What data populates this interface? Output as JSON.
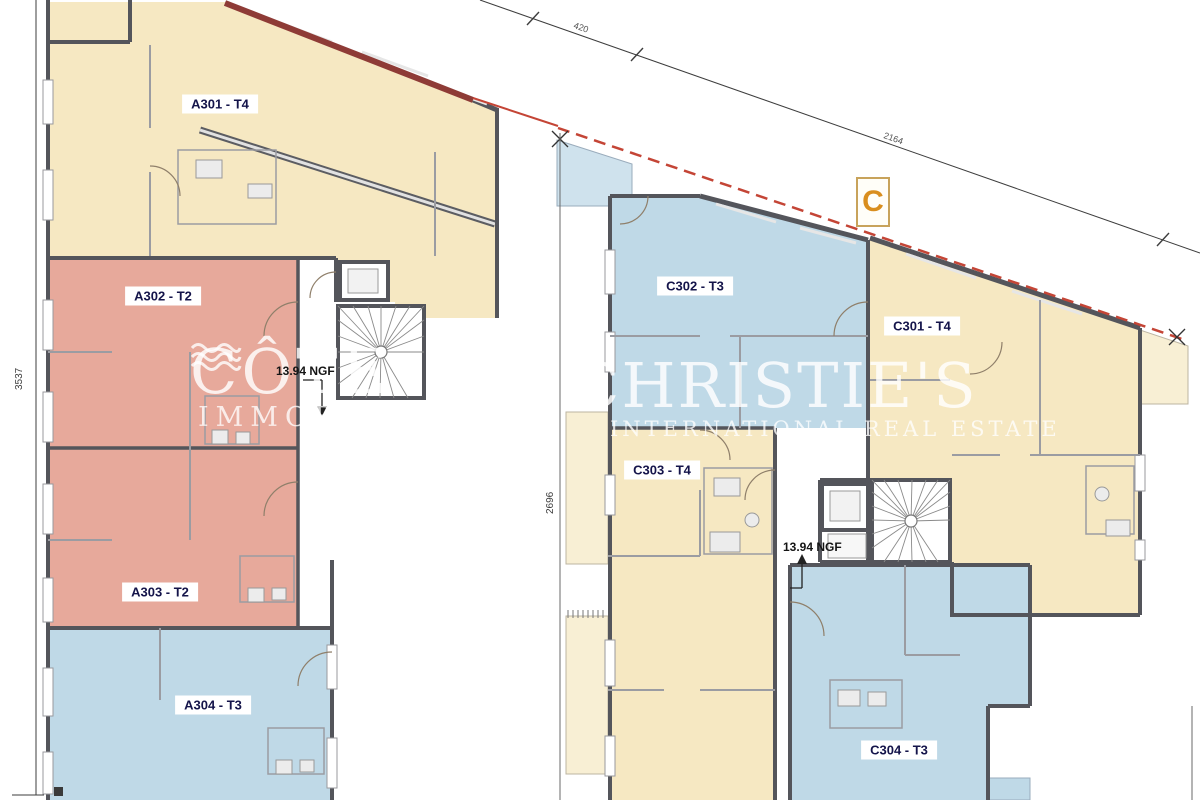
{
  "plan": {
    "marker_c": "C",
    "units": [
      {
        "id": "A301",
        "label": "A301 - T4",
        "type": "T4",
        "color": "#F6E8C2"
      },
      {
        "id": "A302",
        "label": "A302 - T2",
        "type": "T2",
        "color": "#E7A99B"
      },
      {
        "id": "A303",
        "label": "A303 - T2",
        "type": "T2",
        "color": "#E7A99B"
      },
      {
        "id": "A304",
        "label": "A304 - T3",
        "type": "T3",
        "color": "#BFD9E7"
      },
      {
        "id": "C301",
        "label": "C301 - T4",
        "type": "T4",
        "color": "#F6E8C2"
      },
      {
        "id": "C302",
        "label": "C302 - T3",
        "type": "T3",
        "color": "#BFD9E7"
      },
      {
        "id": "C303",
        "label": "C303 - T4",
        "type": "T4",
        "color": "#F6E8C2"
      },
      {
        "id": "C304",
        "label": "C304 - T3",
        "type": "T3",
        "color": "#BFD9E7"
      }
    ],
    "levels": {
      "a": "13.94 NGF",
      "c": "13.94 NGF"
    },
    "dimensions": {
      "left": "3537",
      "middle": "2696",
      "top_small": "420",
      "top_long": "2164"
    },
    "colors": {
      "t4_cream": "#F6E8C2",
      "t2_salmon": "#E7A99B",
      "t3_blue": "#BFD9E7",
      "terrace_cream": "#F8EFD4",
      "terrace_blue": "#CFE2ED",
      "wall": "#54555B",
      "boundary_red": "#C44536",
      "boundary_red_dark": "#8E3B36",
      "marker_orange": "#D98E1E"
    },
    "watermarks": {
      "left": {
        "line1": "CÔTE",
        "line2": "IMMOBILIER",
        "icon": "waves-icon"
      },
      "right": {
        "line1": "CHRISTIE'S",
        "line2": "INTERNATIONAL REAL ESTATE"
      }
    }
  }
}
